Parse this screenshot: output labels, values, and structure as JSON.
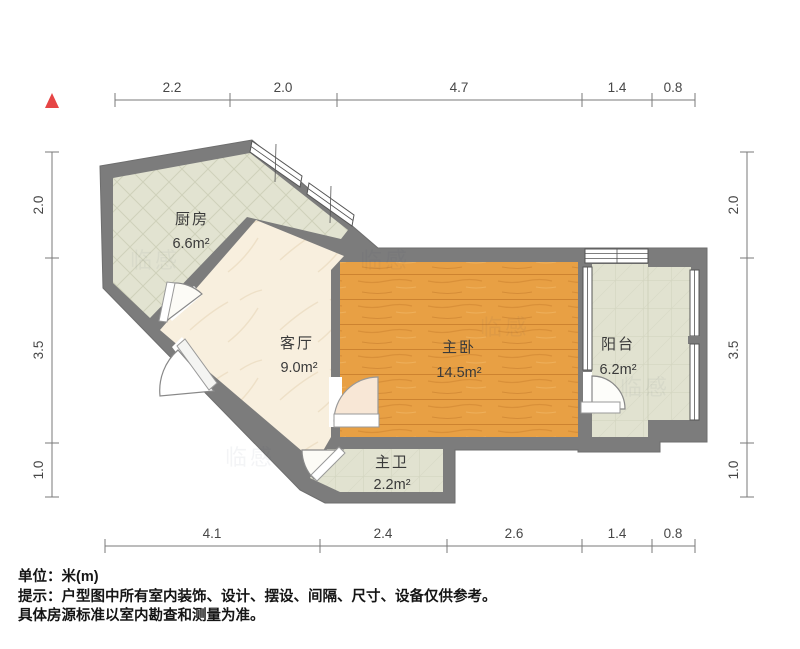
{
  "plan": {
    "rooms": [
      {
        "id": "kitchen",
        "name": "厨房",
        "area": "6.6m²"
      },
      {
        "id": "living",
        "name": "客厅",
        "area": "9.0m²"
      },
      {
        "id": "bedroom",
        "name": "主卧",
        "area": "14.5m²"
      },
      {
        "id": "balcony",
        "name": "阳台",
        "area": "6.2m²"
      },
      {
        "id": "bathroom",
        "name": "主卫",
        "area": "2.2m²"
      }
    ],
    "dimensions_m": {
      "top": [
        "2.2",
        "2.0",
        "4.7",
        "1.4",
        "0.8"
      ],
      "bottom": [
        "4.1",
        "2.4",
        "2.6",
        "1.4",
        "0.8"
      ],
      "left": [
        "2.0",
        "3.5",
        "1.0"
      ],
      "right": [
        "2.0",
        "3.5",
        "1.0"
      ]
    },
    "watermark": "临感"
  },
  "notes": {
    "unit": "单位：米(m)",
    "tip": "提示：户型图中所有室内装饰、设计、摆设、间隔、尺寸、设备仅供参考。",
    "tip2": "具体房源标准以室内勘查和测量为准。"
  },
  "colors": {
    "wall": "#7c7c7c",
    "tile": "#e2e3d1",
    "wood": "#e8a044",
    "cream": "#f8efde",
    "north_arrow": "#e64545",
    "dimension_text": "#474747"
  }
}
